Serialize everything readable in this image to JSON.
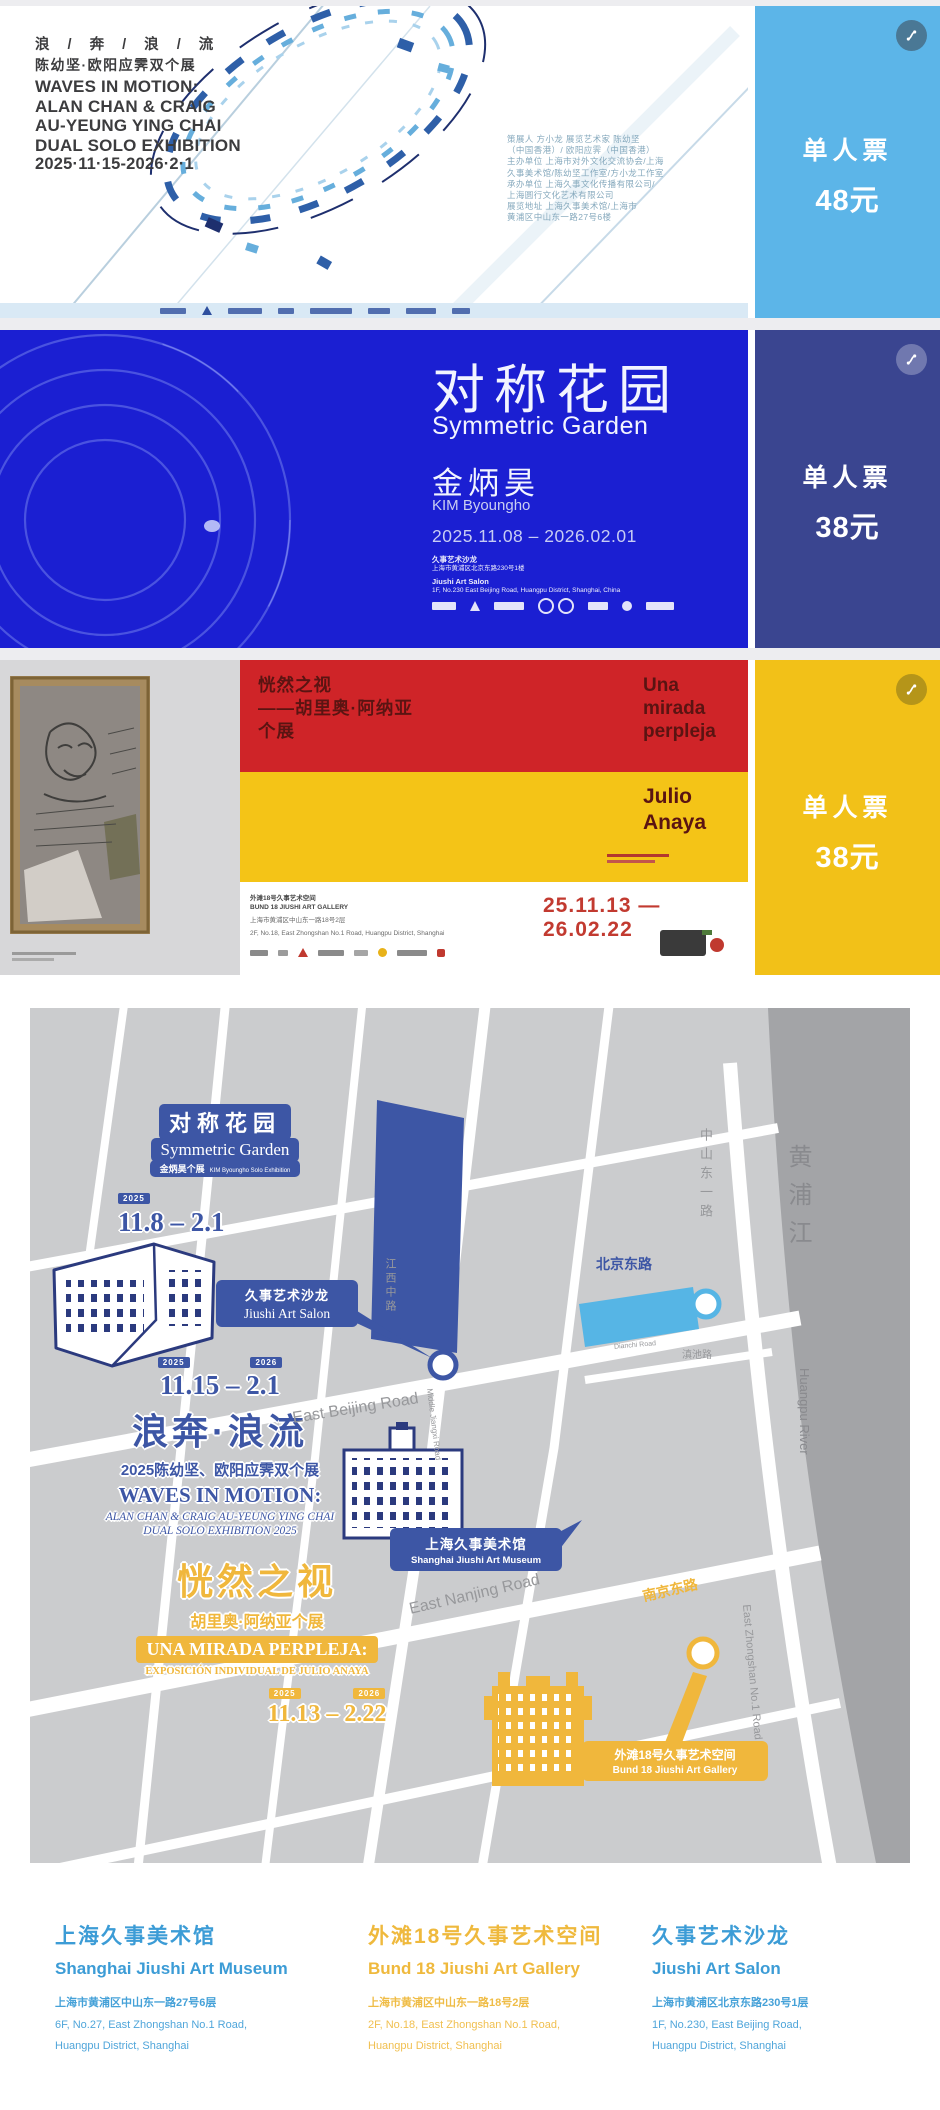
{
  "tickets": {
    "t1": {
      "title_lines": [
        "浪 / 奔 / 浪 / 流",
        "陈幼坚·欧阳应霁双个展",
        "WAVES IN MOTION:",
        "ALAN CHAN & CRAIG",
        "AU-YEUNG YING CHAI",
        "DUAL SOLO EXHIBITION",
        "2025·11·15-2026·2·1"
      ],
      "info_lines": [
        "策展人 方小龙 展览艺术家 陈幼坚",
        "（中国香港）/ 欧阳应霁（中国香港）",
        "主办单位 上海市对外文化交流协会/上海",
        "久事美术馆/陈幼坚工作室/方小龙工作室",
        "承办单位 上海久事文化传播有限公司/",
        "上海圆行文化艺术有限公司",
        "展览地址 上海久事美术馆/上海市",
        "黄浦区中山东一路27号6楼"
      ],
      "price_label": "单人票",
      "price_value": "48元"
    },
    "t2": {
      "title_zh": "对称花园",
      "title_en": "Symmetric Garden",
      "artist_zh": "金炳昊",
      "artist_en": "KIM Byoungho",
      "dates": "2025.11.08 – 2026.02.01",
      "venue_lines": [
        "久事艺术沙龙",
        "上海市黄浦区北京东路230号1楼",
        "Jiushi Art Salon",
        "1F, No.230 East Beijing Road, Huangpu District, Shanghai, China"
      ],
      "price_label": "单人票",
      "price_value": "38元"
    },
    "t3": {
      "title_lines": [
        "恍然之视",
        "——胡里奥·阿纳亚",
        "个展"
      ],
      "subtitle_lines": [
        "Una",
        "mirada",
        "perpleja"
      ],
      "artist_lines": [
        "Julio",
        "Anaya"
      ],
      "dates": "25.11.13 — 26.02.22",
      "info_lines": [
        "外滩18号久事艺术空间",
        "BUND 18 JIUSHI ART GALLERY",
        "上海市黄浦区中山东一路18号2层",
        "2F, No.18, East Zhongshan No.1 Road, Huangpu District, Shanghai"
      ],
      "price_label": "单人票",
      "price_value": "38元"
    }
  },
  "map": {
    "symmetric_garden": {
      "title_zh": "对称花园",
      "title_en": "Symmetric Garden",
      "sub_zh": "金炳昊个展",
      "sub_en": "KIM Byoungho Solo Exhibition",
      "year": "2025",
      "dates": "11.8 – 2.1"
    },
    "waves": {
      "year_start": "2025",
      "year_end": "2026",
      "dates": "11.15 – 2.1",
      "title_zh": "浪奔·浪流",
      "sub_zh": "2025陈幼坚、欧阳应霁双个展",
      "title_en": "WAVES IN MOTION:",
      "sub_en1": "ALAN CHAN & CRAIG AU-YEUNG YING CHAI",
      "sub_en2": "DUAL SOLO EXHIBITION 2025"
    },
    "perpleja": {
      "title_zh": "恍然之视",
      "sub_zh": "胡里奥·阿纳亚个展",
      "title_es": "UNA MIRADA PERPLEJA:",
      "sub_es": "EXPOSICIÓN INDIVIDUAL DE JULIO ANAYA",
      "year_start": "2025",
      "year_end": "2026",
      "dates": "11.13 – 2.22"
    },
    "callouts": {
      "salon_zh": "久事艺术沙龙",
      "salon_en": "Jiushi Art Salon",
      "museum_zh": "上海久事美术馆",
      "museum_en": "Shanghai Jiushi Art Museum",
      "bund18_zh": "外滩18号久事艺术空间",
      "bund18_en": "Bund 18 Jiushi Art Gallery"
    },
    "roads": {
      "east_beijing": "East Beijing Road",
      "beijing_zh": "北京东路",
      "dianchi_zh": "滇池路",
      "dianchi_en": "Dianchi Road",
      "jiangxi_zh": "江西中路",
      "jiangxi_en": "Middle Jiangxi Road",
      "zhongshan_zh": "中山东一路",
      "zhongshan_en": "East Zhongshan No.1 Road",
      "east_nanjing": "East Nanjing Road",
      "nanjing_zh": "南京东路",
      "river_zh": "黄浦江",
      "river_en": "Huangpu River"
    }
  },
  "venues": [
    {
      "name_zh": "上海久事美术馆",
      "name_en": "Shanghai Jiushi Art Museum",
      "addr_zh": "上海市黄浦区中山东一路27号6层",
      "addr_en1": "6F, No.27, East Zhongshan No.1 Road,",
      "addr_en2": "Huangpu District, Shanghai"
    },
    {
      "name_zh": "外滩18号久事艺术空间",
      "name_en": "Bund 18 Jiushi Art Gallery",
      "addr_zh": "上海市黄浦区中山东一路18号2层",
      "addr_en1": "2F, No.18, East Zhongshan No.1 Road,",
      "addr_en2": "Huangpu District, Shanghai"
    },
    {
      "name_zh": "久事艺术沙龙",
      "name_en": "Jiushi Art Salon",
      "addr_zh": "上海市黄浦区北京东路230号1层",
      "addr_en1": "1F, No.230, East Beijing Road,",
      "addr_en2": "Huangpu District, Shanghai"
    }
  ],
  "colors": {
    "t1_price": "#5CB5E8",
    "t2_bg": "#1B1FD2",
    "t2_price": "#3A4590",
    "t3_red": "#CF2428",
    "t3_yellow": "#F4C417",
    "map_blue": "#3D56A5",
    "map_lightblue": "#56B5E5",
    "map_yellow": "#F0B73C"
  }
}
